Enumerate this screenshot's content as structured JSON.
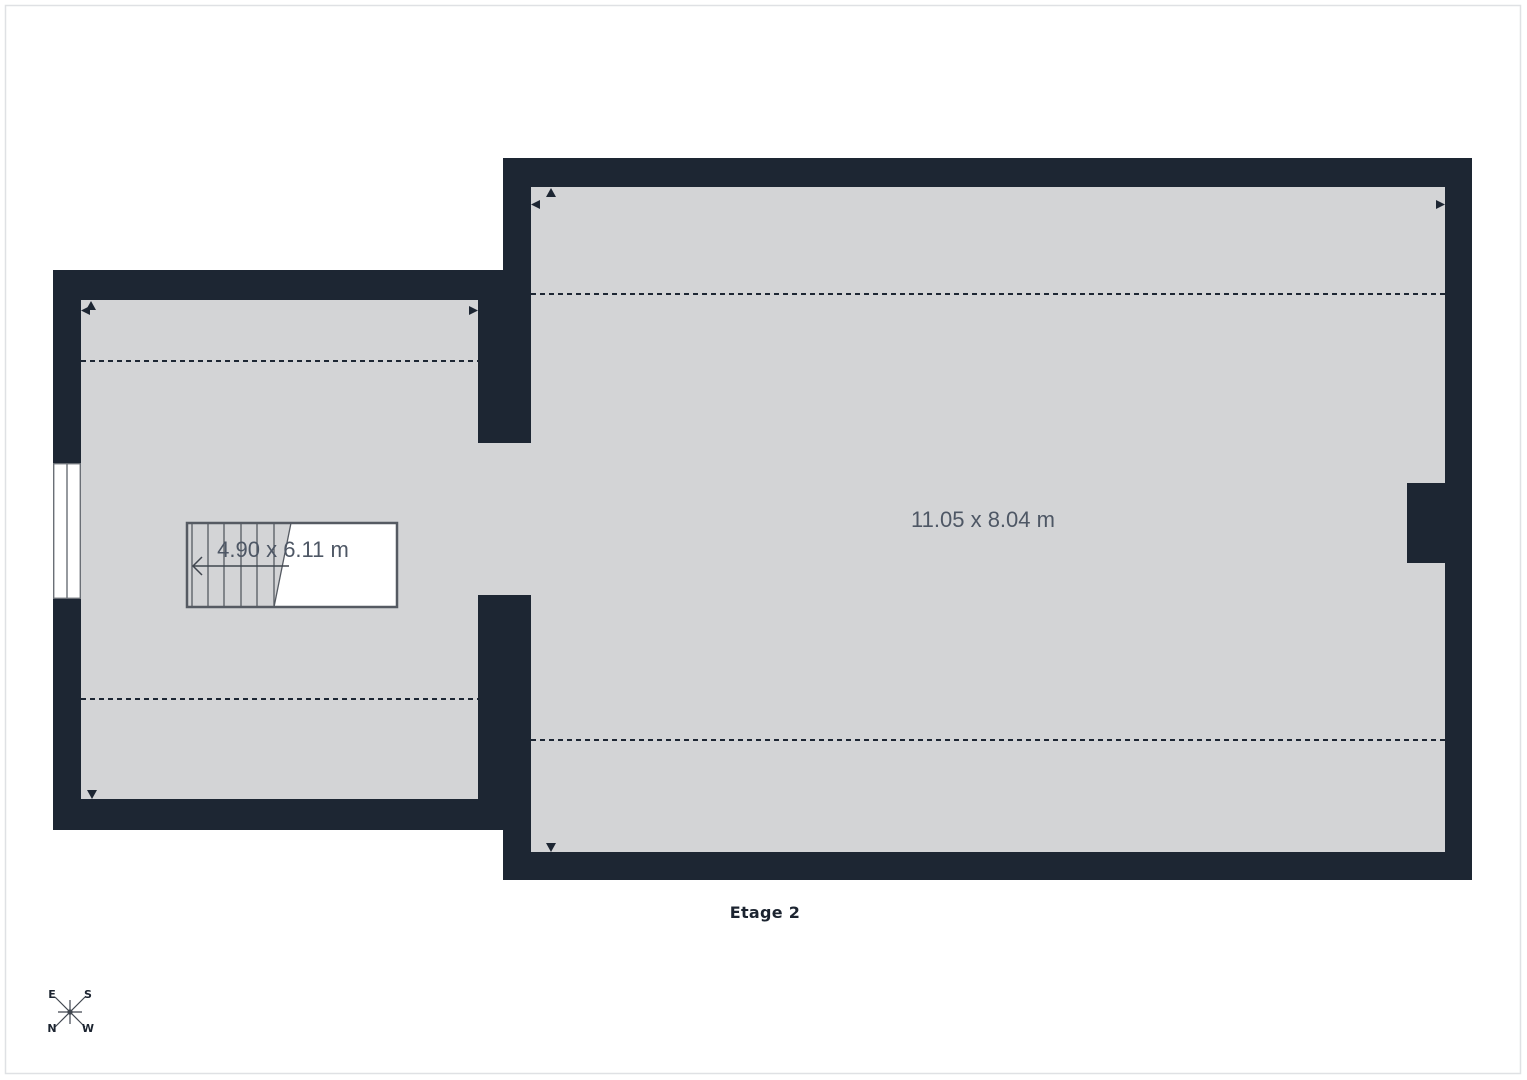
{
  "floor_label": "Etage 2",
  "rooms": {
    "left": {
      "dimensions": "4.90 x 6.11 m"
    },
    "right": {
      "dimensions": "11.05 x 8.04 m"
    }
  },
  "compass": {
    "east": "E",
    "south": "S",
    "north": "N",
    "west": "W"
  },
  "colors": {
    "wall": "#1d2633",
    "floor": "#d3d4d6",
    "outside": "#ffffff",
    "page_border": "#dfe1e4",
    "dim_text": "#4e5765",
    "label_text": "#1c2430",
    "stair_line": "#555a62",
    "compass_line": "#40464f"
  }
}
